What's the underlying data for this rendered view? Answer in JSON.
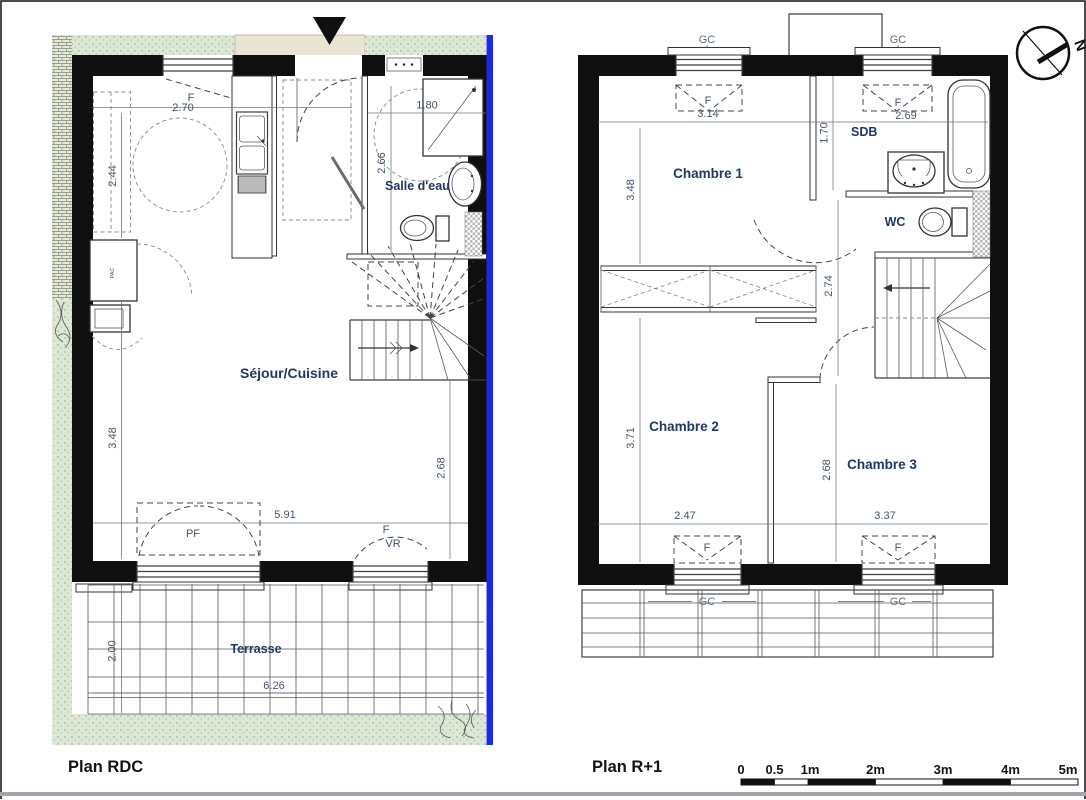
{
  "plan_rdc": {
    "title": "Plan RDC",
    "rooms": {
      "sejour": "Séjour/Cuisine",
      "salle_eau": "Salle d'eau",
      "terrasse": "Terrasse"
    },
    "labels": {
      "f_top": "F",
      "pf": "PF",
      "f_bottom": "F",
      "vr": "VR",
      "pac": "PAC"
    },
    "dims": {
      "top_w": "2.70",
      "kitchen_h": "2.44",
      "shower_w": "1.80",
      "bath_h": "2.66",
      "sejour_h": "3.48",
      "right_h": "2.68",
      "bottom_w": "5.91",
      "terrasse_h": "2.00",
      "terrasse_w": "6.26"
    }
  },
  "plan_r1": {
    "title": "Plan R+1",
    "rooms": {
      "ch1": "Chambre 1",
      "ch2": "Chambre 2",
      "ch3": "Chambre 3",
      "sdb": "SDB",
      "wc": "WC"
    },
    "labels": {
      "gc_top_left": "GC",
      "gc_top_right": "GC",
      "gc_bottom_left": "GC",
      "gc_bottom_right": "GC",
      "f_top_left": "F",
      "f_top_right": "F",
      "f_bottom_left": "F",
      "f_bottom_right": "F"
    },
    "dims": {
      "ch1_w": "3.14",
      "top_right_w": "2.69",
      "ch1_h": "3.48",
      "sdb_h": "1.70",
      "landing_h": "2.74",
      "ch2_h": "3.71",
      "ch3_h": "2.68",
      "ch2_w": "2.47",
      "ch3_w": "3.37"
    }
  },
  "compass": {
    "north": "N"
  },
  "scale_bar": {
    "ticks": [
      "0",
      "0.5",
      "1m",
      "2m",
      "3m",
      "4m",
      "5m"
    ]
  },
  "colors": {
    "wall": "#0f0f0f",
    "line": "#3f3f3f",
    "room_label": "#1f3864",
    "dim_text": "#44546a",
    "gc_text": "#5d6d80",
    "green_fill": "#dce8d5",
    "green_dot": "#8aa07c",
    "beige_fill": "#eae4d2",
    "blue_property_line": "#1b2ae6",
    "footer_rule": "#9fa5ab"
  }
}
